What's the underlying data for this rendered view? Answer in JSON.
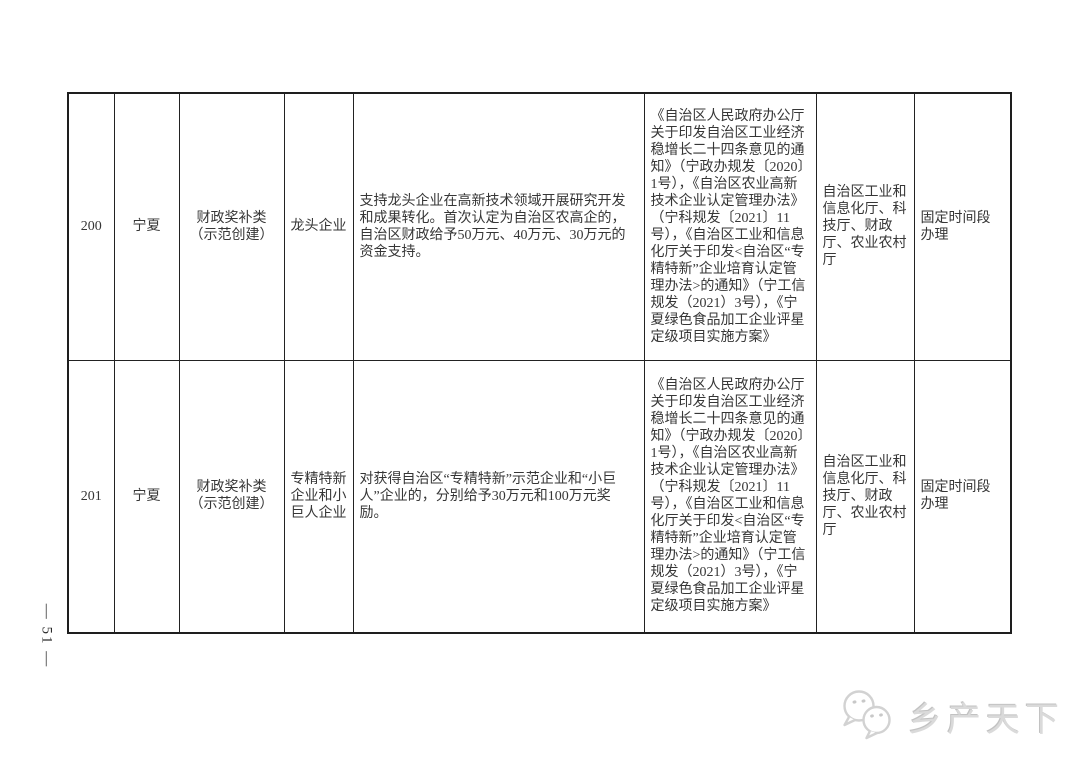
{
  "page": {
    "page_number": "— 51 —"
  },
  "watermark": {
    "text": "乡产天下",
    "icon": "chat-bubbles-icon",
    "color": "#d6d6d6"
  },
  "table": {
    "border_color": "#1e1e1e",
    "rows": [
      {
        "id": "200",
        "region": "宁夏",
        "category": "财政奖补类\n（示范创建）",
        "enterprise_type": "龙头企业",
        "support": "支持龙头企业在高新技术领域开展研究开发和成果转化。首次认定为自治区农高企的，自治区财政给予50万元、40万元、30万元的资金支持。",
        "policy_basis": "《自治区人民政府办公厅关于印发自治区工业经济稳增长二十四条意见的通知》（宁政办规发〔2020〕1号），《自治区农业高新技术企业认定管理办法》（宁科规发〔2021〕11号），《自治区工业和信息化厅关于印发<自治区“专精特新”企业培育认定管理办法>的通知》（宁工信规发（2021）3号），《宁夏绿色食品加工企业评星定级项目实施方案》",
        "departments": "自治区工业和信息化厅、科技厅、财政厅、农业农村厅",
        "handling": "固定时间段办理"
      },
      {
        "id": "201",
        "region": "宁夏",
        "category": "财政奖补类\n（示范创建）",
        "enterprise_type": "专精特新企业和小巨人企业",
        "support": "对获得自治区“专精特新”示范企业和“小巨人”企业的，分别给予30万元和100万元奖励。",
        "policy_basis": "《自治区人民政府办公厅关于印发自治区工业经济稳增长二十四条意见的通知》（宁政办规发〔2020〕1号），《自治区农业高新技术企业认定管理办法》（宁科规发〔2021〕11号），《自治区工业和信息化厅关于印发<自治区“专精特新”企业培育认定管理办法>的通知》（宁工信规发（2021）3号），《宁夏绿色食品加工企业评星定级项目实施方案》",
        "departments": "自治区工业和信息化厅、科技厅、财政厅、农业农村厅",
        "handling": "固定时间段办理"
      }
    ]
  }
}
